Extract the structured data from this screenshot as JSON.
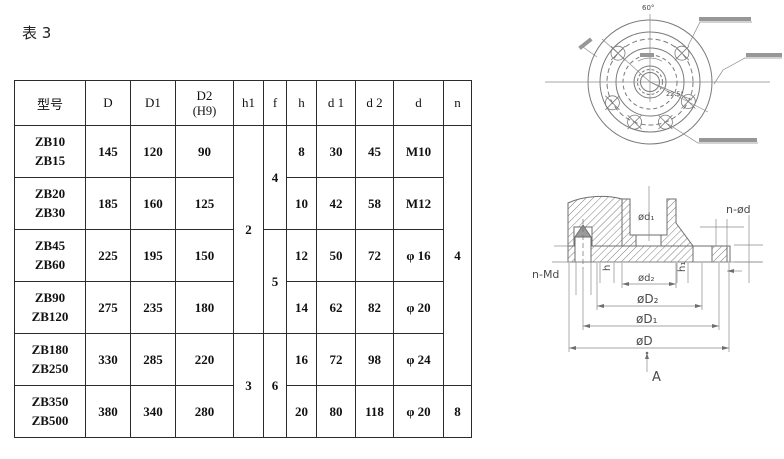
{
  "page": {
    "title": "表 3"
  },
  "table": {
    "headers": [
      "型号",
      "D",
      "D1",
      "D2",
      "h1",
      "f",
      "h",
      "d 1",
      "d 2",
      "d",
      "n"
    ],
    "header_d2_sub": "(H9)",
    "rows": [
      {
        "models": [
          "ZB10",
          "ZB15"
        ],
        "D": "145",
        "D1": "120",
        "D2": "90",
        "h": "8",
        "d1": "30",
        "d2": "45",
        "d": "M10"
      },
      {
        "models": [
          "ZB20",
          "ZB30"
        ],
        "D": "185",
        "D1": "160",
        "D2": "125",
        "h": "10",
        "d1": "42",
        "d2": "58",
        "d": "M12"
      },
      {
        "models": [
          "ZB45",
          "ZB60"
        ],
        "D": "225",
        "D1": "195",
        "D2": "150",
        "h": "12",
        "d1": "50",
        "d2": "72",
        "d": "φ 16"
      },
      {
        "models": [
          "ZB90",
          "ZB120"
        ],
        "D": "275",
        "D1": "235",
        "D2": "180",
        "h": "14",
        "d1": "62",
        "d2": "82",
        "d": "φ 20"
      },
      {
        "models": [
          "ZB180",
          "ZB250"
        ],
        "D": "330",
        "D1": "285",
        "D2": "220",
        "h": "16",
        "d1": "72",
        "d2": "98",
        "d": "φ 24"
      },
      {
        "models": [
          "ZB350",
          "ZB500"
        ],
        "D": "380",
        "D1": "340",
        "D2": "280",
        "h": "20",
        "d1": "80",
        "d2": "118",
        "d": "φ 20"
      }
    ],
    "merged": {
      "h1": [
        {
          "value": "2",
          "rows": "1-4"
        },
        {
          "value": "3",
          "rows": "5-6"
        }
      ],
      "f": [
        {
          "value": "4",
          "rows": "1-2"
        },
        {
          "value": "5",
          "rows": "3-4"
        },
        {
          "value": "6",
          "rows": "5-6"
        }
      ],
      "n": [
        {
          "value": "4",
          "rows": "1-5"
        },
        {
          "value": "8",
          "rows": "6"
        }
      ]
    }
  },
  "drawings": {
    "top_view": {
      "angle_top": "60°",
      "angle_right": "22.5°"
    },
    "section_view": {
      "bore_label": "ød₁",
      "od2": "ød₂",
      "oD2": "øD₂",
      "oD1": "øD₁",
      "oD": "øD",
      "h": "h",
      "h1": "h₁",
      "n_od": "n-ød",
      "n_md": "n-Md",
      "view": "A"
    },
    "colors": {
      "line": "#777777",
      "dark_line": "#2b2b2b"
    }
  }
}
